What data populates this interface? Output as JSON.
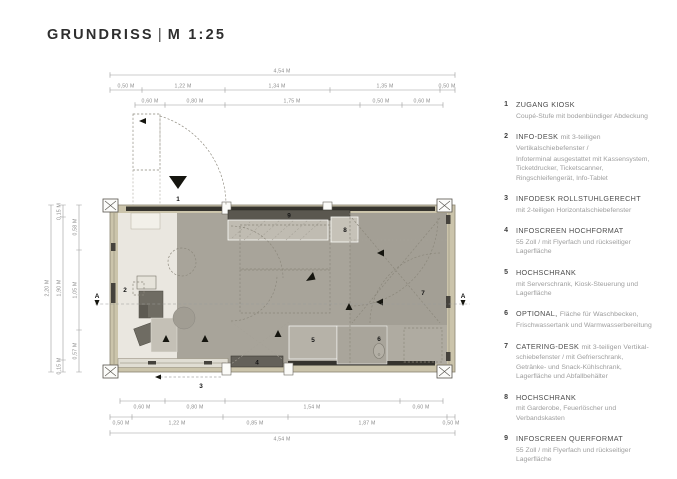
{
  "title": {
    "main": "GRUNDRISS",
    "sep": "|",
    "scale": "M 1:25"
  },
  "legend": {
    "items": [
      {
        "num": "1",
        "title": "ZUGANG KIOSK",
        "title_suffix": "",
        "desc": "Coupé-Stufe mit bodenbündiger Abdeckung"
      },
      {
        "num": "2",
        "title": "INFO-DESK",
        "title_suffix": "mit 3-teiligen Vertikalschiebefenster /",
        "desc": "Infoterminal ausgestattet mit Kassensystem, Ticketdrucker, Ticketscanner, Ringschleifengerät, Info-Tablet"
      },
      {
        "num": "3",
        "title": "INFODESK ROLLSTUHLGERECHT",
        "title_suffix": "",
        "desc": "mit 2-teiligen Horizontalschiebefenster"
      },
      {
        "num": "4",
        "title": "INFOSCREEN HOCHFORMAT",
        "title_suffix": "",
        "desc": "55 Zoll / mit Flyerfach und rückseitiger Lagerfläche"
      },
      {
        "num": "5",
        "title": "HOCHSCHRANK",
        "title_suffix": "",
        "desc": "mit Serverschrank, Kiosk-Steuerung und Lagerfläche"
      },
      {
        "num": "6",
        "title": "OPTIONAL,",
        "title_suffix": "Fläche für Waschbecken,",
        "desc": "Frischwassertank und Warmwasserbereitung"
      },
      {
        "num": "7",
        "title": "CATERING-DESK",
        "title_suffix": "mit 3-teiligen Vertikal-",
        "desc": "schiebefenster / mit Gefrierschrank, Getränke- und Snack-Kühlschrank, Lagerfläche und Abfallbehälter"
      },
      {
        "num": "8",
        "title": "HOCHSCHRANK",
        "title_suffix": "",
        "desc": "mit Garderobe, Feuerlöscher und Verbandskasten"
      },
      {
        "num": "9",
        "title": "INFOSCREEN QUERFORMAT",
        "title_suffix": "",
        "desc": "55 Zoll / mit Flyerfach und rückseitiger Lagerfläche"
      }
    ]
  },
  "dims": {
    "top_total": "4,54 M",
    "top_row2": [
      "0,50 M",
      "1,22 M",
      "1,34 M",
      "1,35 M",
      "0,50 M"
    ],
    "top_row3": [
      "0,60 M",
      "0,80 M",
      "1,75 M",
      "0,50 M",
      "0,60 M"
    ],
    "bottom_row1": [
      "0,60 M",
      "0,80 M",
      "1,54 M",
      "0,60 M"
    ],
    "bottom_row2": [
      "0,50 M",
      "1,22 M",
      "0,85 M",
      "1,87 M",
      "0,50 M"
    ],
    "bottom_total": "4,54 M",
    "left_total": "2,20 M",
    "left_row2": [
      "0,15 M",
      "1,90 M",
      "0,15 M"
    ],
    "left_row3": [
      "0,58 M",
      "1,05 M",
      "0,57 M"
    ]
  },
  "plan": {
    "markers": [
      "1",
      "2",
      "3",
      "4",
      "5",
      "6",
      "7",
      "8",
      "9"
    ],
    "section_label": "A"
  },
  "colors": {
    "wall_tan": "#cbc4ab",
    "floor_light": "#eae7e0",
    "floor_mid": "#a8a49a",
    "floor_right": "#afaba1",
    "dark_strip": "#36342e",
    "furniture": "#6f6c63",
    "screen_bar": "#5a574f",
    "dim_text": "#8c8c8c"
  }
}
